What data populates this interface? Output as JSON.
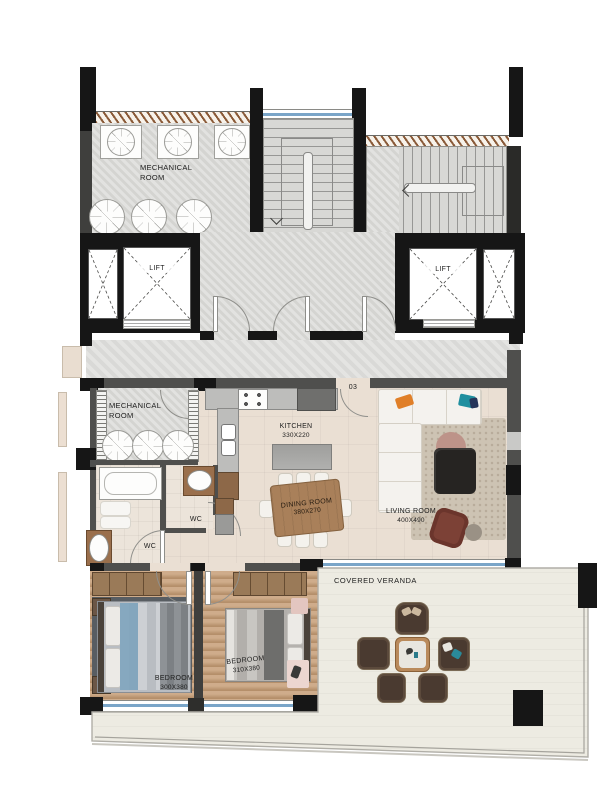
{
  "labels": {
    "unit_number": "03",
    "mech_room_upper": {
      "line1": "MECHANICAL",
      "line2": "ROOM"
    },
    "mech_room_lower": {
      "line1": "MECHANICAL",
      "line2": "ROOM"
    },
    "lift_left": "LIFT",
    "lift_right": "LIFT",
    "kitchen": {
      "name": "KITCHEN",
      "dims": "330X220"
    },
    "dining_room": {
      "name": "DINING ROOM",
      "dims": "380X270"
    },
    "living_room": {
      "name": "LIVING ROOM",
      "dims": "400X490"
    },
    "wc_bath": "WC",
    "wc_guest": "WC",
    "bedroom_left": {
      "name": "BEDROOM",
      "dims": "300X380"
    },
    "bedroom_right": {
      "name": "BEDROOM",
      "dims": "310X380"
    },
    "veranda": "COVERED VERANDA"
  },
  "colors": {
    "wall_black": "#161616",
    "wall_gray": "#4f4f4d",
    "common_floor": "#d8d8d5",
    "apartment_floor": "#eadfd3",
    "wood_floor": "#c8a17b",
    "veranda_floor": "#edebe2",
    "window_glass": "#7aa5c8",
    "hatch_brown": "#8a5a38",
    "wood_furniture": "#a9805a",
    "sofa_white": "#f4f2ee",
    "accent_orange": "#e07f28",
    "accent_teal": "#1f8f9f"
  }
}
